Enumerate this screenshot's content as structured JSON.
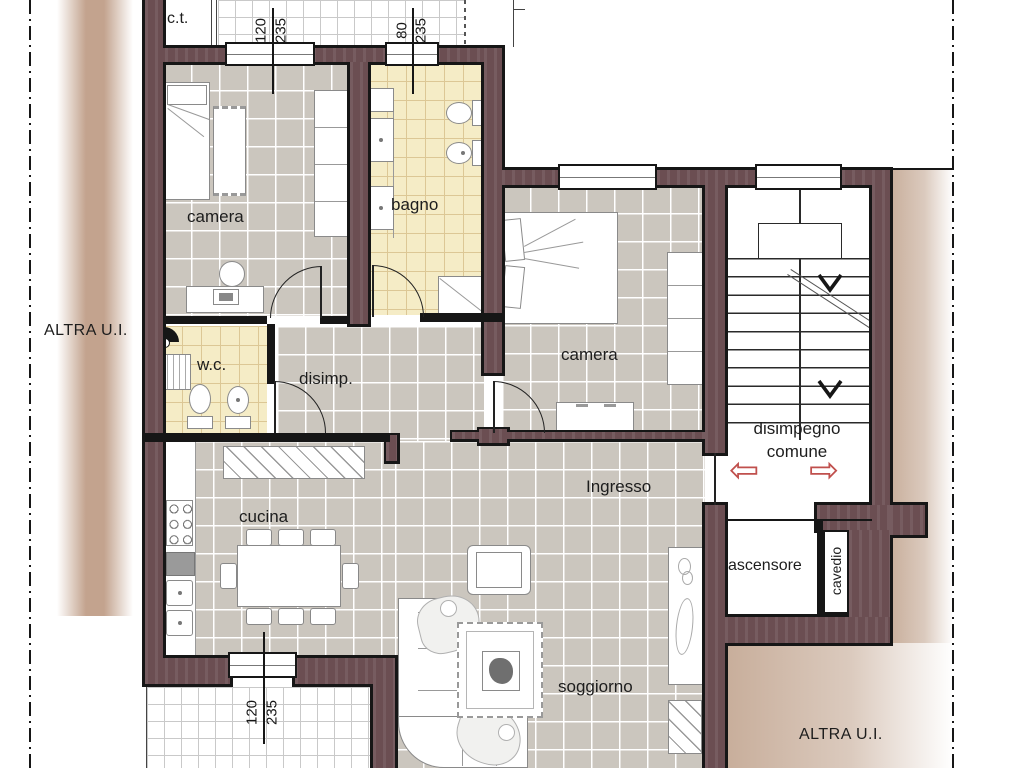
{
  "outside": {
    "left_label": "ALTRA U.I.",
    "right_label": "ALTRA U.I."
  },
  "rooms": {
    "ct": "c.t.",
    "camera1": "camera",
    "bagno": "bagno",
    "wc": "w.c.",
    "disimp": "disimp.",
    "camera2": "camera",
    "cucina": "cucina",
    "ingresso": "Ingresso",
    "soggiorno": "soggiorno",
    "disimpegno_line1": "disimpegno",
    "disimpegno_line2": "comune",
    "ascensore": "ascensore",
    "cavedio": "cavedio"
  },
  "dimensions": {
    "win_top1_width": "120",
    "win_top1_height": "235",
    "win_top2_width": "80",
    "win_top2_height": "235",
    "win_bottom_width": "120",
    "win_bottom_height": "235"
  },
  "icons": {
    "exit_arrow_left": "⇦",
    "exit_arrow_right": "⇨"
  },
  "colors": {
    "wall": "#6b4e52",
    "floor_tile_gray": "#cbc6be",
    "floor_tile_cream": "#f5ecc6",
    "outside_band_tan": "#c3a38e",
    "exit_arrow_red": "#c0504d"
  }
}
